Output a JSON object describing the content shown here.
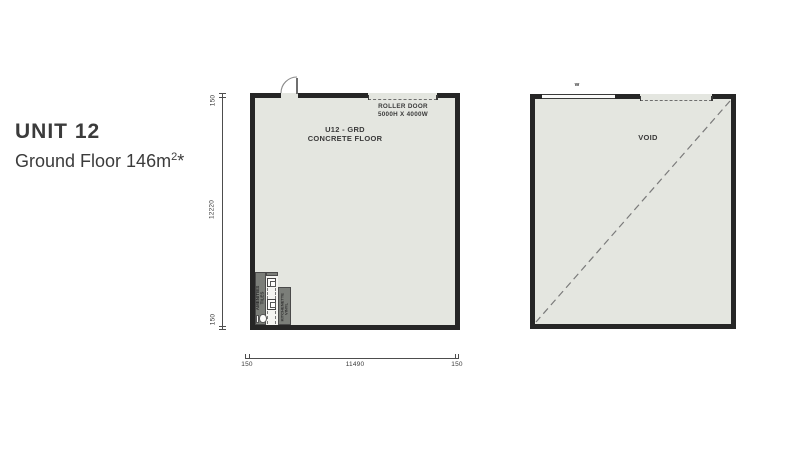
{
  "header": {
    "title": "UNIT 12",
    "subtitle_prefix": "Ground Floor 146m",
    "subtitle_sup": "2",
    "subtitle_suffix": "*"
  },
  "left_plan": {
    "room_label_line1": "U12 - GRD",
    "room_label_line2": "CONCRETE FLOOR",
    "roller_door_line1": "ROLLER DOOR",
    "roller_door_line2": "5000H X 4000W",
    "amenities_label_line1": "AMENITIES",
    "amenities_label_line2": "TILES",
    "kitchenette_label_line1": "KITCHENETTE",
    "kitchenette_label_line2": "VINYL"
  },
  "right_plan": {
    "label": "VOID",
    "window_label": "W"
  },
  "dimensions": {
    "left": [
      "150",
      "12220",
      "150"
    ],
    "bottom": [
      "150",
      "11490",
      "150"
    ]
  },
  "colors": {
    "floor": "#e4e6e0",
    "wall": "#262626",
    "room_block": "#7b7e79",
    "dash": "#6e6e6e",
    "dimension": "#4d4d4d",
    "text": "#3b3b3b"
  }
}
